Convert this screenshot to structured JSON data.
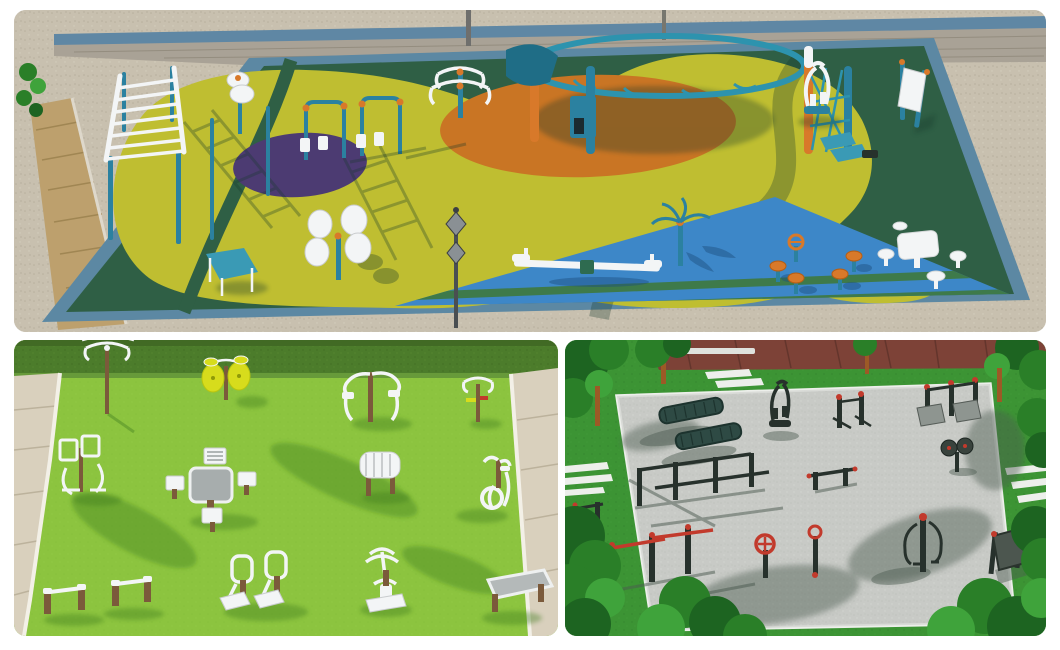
{
  "page": {
    "background": "#ffffff",
    "kind": "collage-of-3d-park-renders"
  },
  "panels": {
    "top": {
      "name": "aerial-playground-render",
      "colors": {
        "sand": "#c8c0af",
        "paver": "#bda06d",
        "wall": "#a9a296",
        "rail": "#5f87a4",
        "rim": "#5c88a3",
        "floor": "#2f5f45",
        "yellow": "#bfbe31",
        "purple": "#4c3b72",
        "orange": "#c97524",
        "blue": "#3d87c8",
        "equipment_teal": "#2b81a0",
        "equipment_orange": "#d8792a",
        "equipment_white": "#f3f5f6"
      },
      "equipment": [
        "horizontal-ladder",
        "pull-up-pole",
        "tai-chi-spinner-small",
        "quad-leg-press",
        "sit-up-bench",
        "tai-chi-discs",
        "climbing-dome",
        "tai-chi-spinner",
        "elliptical-trainer",
        "info-sign",
        "picnic-table-with-stools",
        "mushroom-stools-and-wheel",
        "rotating-carousel",
        "seesaw",
        "lamp-post"
      ]
    },
    "bottom_left": {
      "name": "lawn-gym-render",
      "colors": {
        "lawn": "#8cc43f",
        "hedge": "#4d7c2b",
        "path": "#d9d0bd",
        "curb": "#f3f0e7",
        "metal": "#f3f5f6",
        "wood": "#7b5a3b",
        "table": "#a7adad",
        "disc_yellow": "#d7dc1c"
      },
      "equipment": [
        "tai-chi-spinner",
        "pendulum-swing",
        "tai-chi-discs",
        "dip-station",
        "chess-table-with-stools",
        "roller-massager",
        "twister",
        "exercise-bike",
        "double-leg-press",
        "push-up-bars",
        "rider-machine",
        "sit-up-board"
      ]
    },
    "bottom_right": {
      "name": "street-workout-render",
      "colors": {
        "grass": "#3d9434",
        "foliage": "#2a7f28",
        "trunk": "#9c5a26",
        "brick": "#7d4237",
        "gravel": "#c8cbc6",
        "curb": "#edefeb",
        "steel": "#27312c",
        "red": "#c23a2c"
      },
      "equipment": [
        "park-benches",
        "parallel-bars",
        "pull-up-bars",
        "elliptical-trainer",
        "leg-press-decks",
        "chest-press",
        "tai-chi-wheels",
        "balance-beam",
        "rider-machine",
        "hand-wheel",
        "sign-board",
        "crosswalk-stripes"
      ]
    }
  }
}
